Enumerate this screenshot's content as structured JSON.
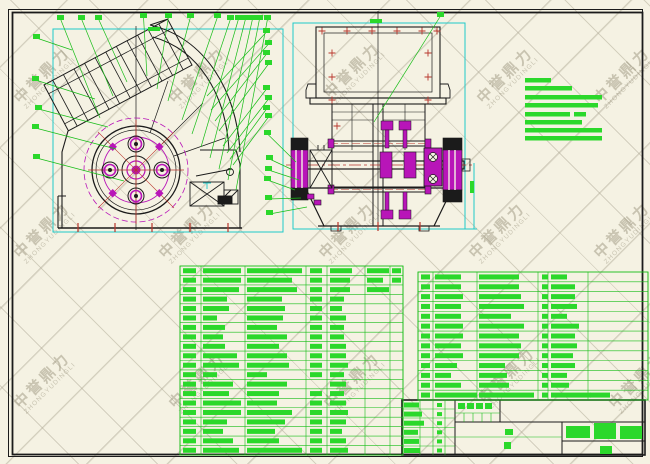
{
  "drawing_type": "cad-assembly-drawing",
  "watermark": {
    "text_cn": "中誉鼎力",
    "text_en": "ZHONGYUDINGLI",
    "positions": [
      [
        45,
        85
      ],
      [
        200,
        85
      ],
      [
        355,
        80
      ],
      [
        508,
        85
      ],
      [
        625,
        85
      ],
      [
        45,
        240
      ],
      [
        190,
        240
      ],
      [
        350,
        240
      ],
      [
        500,
        240
      ],
      [
        625,
        240
      ],
      [
        45,
        390
      ],
      [
        200,
        390
      ],
      [
        355,
        390
      ],
      [
        510,
        385
      ],
      [
        640,
        390
      ]
    ]
  },
  "colors": {
    "background": "#f5f2e3",
    "line": "#1b1b1b",
    "green_fill": "#2bd82b",
    "green_line": "#17bd17",
    "cyan": "#1fc9c9",
    "magenta": "#b815b8",
    "red": "#b8352b",
    "watermark": "#968e7a"
  },
  "callouts": [
    [
      57,
      15,
      100,
      118
    ],
    [
      78,
      15,
      113,
      96
    ],
    [
      95,
      15,
      127,
      82
    ],
    [
      140,
      13,
      147,
      76
    ],
    [
      165,
      13,
      157,
      89
    ],
    [
      187,
      13,
      168,
      101
    ],
    [
      214,
      13,
      182,
      120
    ],
    [
      227,
      15,
      192,
      134
    ],
    [
      235,
      15,
      201,
      147
    ],
    [
      242,
      15,
      210,
      158
    ],
    [
      249,
      15,
      219,
      169
    ],
    [
      256,
      15,
      228,
      180
    ],
    [
      264,
      15,
      236,
      190
    ],
    [
      33,
      34,
      72,
      50
    ],
    [
      32,
      76,
      95,
      99
    ],
    [
      35,
      105,
      108,
      127
    ],
    [
      32,
      124,
      116,
      149
    ],
    [
      33,
      154,
      124,
      181
    ],
    [
      263,
      28,
      207,
      96
    ],
    [
      265,
      40,
      211,
      110
    ],
    [
      263,
      50,
      215,
      121
    ],
    [
      265,
      60,
      219,
      131
    ],
    [
      263,
      85,
      223,
      146
    ],
    [
      265,
      95,
      227,
      153
    ],
    [
      263,
      105,
      230,
      159
    ],
    [
      265,
      113,
      233,
      165
    ],
    [
      264,
      130,
      296,
      162
    ],
    [
      266,
      155,
      293,
      170
    ],
    [
      265,
      166,
      299,
      180
    ],
    [
      264,
      176,
      295,
      190
    ],
    [
      265,
      195,
      301,
      198
    ],
    [
      266,
      210,
      307,
      207
    ],
    [
      437,
      12,
      374,
      122
    ]
  ],
  "dimension_marks": [
    [
      148,
      27,
      12,
      4
    ],
    [
      370,
      19,
      12,
      4
    ],
    [
      470,
      181,
      4,
      12
    ]
  ],
  "tech_notes": {
    "x": 525,
    "bar_h": 4.5,
    "bars": [
      [
        78,
        26,
        0
      ],
      [
        86,
        47,
        0
      ],
      [
        95,
        77,
        0
      ],
      [
        103,
        73,
        0
      ],
      [
        112,
        45,
        12
      ],
      [
        120,
        57,
        0
      ],
      [
        128,
        77,
        0
      ],
      [
        136,
        77,
        0
      ]
    ]
  },
  "red_marks": {
    "plus": [
      [
        322,
        31
      ],
      [
        347,
        31
      ],
      [
        372,
        31
      ],
      [
        397,
        31
      ],
      [
        422,
        31
      ],
      [
        437,
        31
      ],
      [
        332,
        53
      ],
      [
        332,
        77
      ],
      [
        332,
        100
      ],
      [
        428,
        53
      ],
      [
        428,
        77
      ],
      [
        428,
        100
      ],
      [
        337,
        126
      ]
    ],
    "ticks": [
      [
        78,
        228
      ],
      [
        115,
        228
      ],
      [
        152,
        228
      ],
      [
        190,
        228
      ],
      [
        228,
        228
      ],
      [
        338,
        227
      ],
      [
        378,
        227
      ],
      [
        420,
        227
      ]
    ]
  },
  "bom_left": {
    "x": 180,
    "y": 266,
    "h": 189,
    "rows": 20,
    "cols": [
      0,
      21,
      65,
      126,
      147,
      185,
      210,
      223
    ],
    "seq_w": 13,
    "qty_w": 12,
    "data": [
      [
        38,
        55,
        1,
        22,
        22,
        1
      ],
      [
        38,
        45,
        1,
        20,
        16,
        1
      ],
      [
        36,
        50,
        1,
        20,
        22,
        0
      ],
      [
        24,
        35,
        1,
        14,
        0,
        0
      ],
      [
        26,
        38,
        1,
        12,
        0,
        0
      ],
      [
        14,
        36,
        1,
        16,
        0,
        0
      ],
      [
        22,
        30,
        1,
        14,
        0,
        0
      ],
      [
        20,
        40,
        1,
        14,
        0,
        0
      ],
      [
        22,
        32,
        1,
        16,
        0,
        0
      ],
      [
        34,
        40,
        1,
        16,
        0,
        0
      ],
      [
        36,
        42,
        1,
        18,
        0,
        0
      ],
      [
        14,
        20,
        1,
        14,
        0,
        0
      ],
      [
        30,
        40,
        0,
        16,
        0,
        0
      ],
      [
        26,
        32,
        1,
        14,
        0,
        0
      ],
      [
        38,
        30,
        1,
        16,
        0,
        0
      ],
      [
        38,
        45,
        1,
        18,
        0,
        0
      ],
      [
        24,
        38,
        1,
        16,
        0,
        0
      ],
      [
        20,
        28,
        1,
        12,
        0,
        0
      ],
      [
        30,
        32,
        1,
        16,
        0,
        0
      ],
      [
        36,
        55,
        1,
        18,
        0,
        0
      ]
    ]
  },
  "bom_right": {
    "x": 418,
    "y": 272,
    "h": 128,
    "rows": 13,
    "cols": [
      0,
      15,
      59,
      120,
      130,
      170,
      230
    ],
    "seq_w": 9,
    "qty_w": 6,
    "data": [
      [
        26,
        40,
        1,
        16,
        0,
        0
      ],
      [
        26,
        40,
        1,
        24,
        0,
        0
      ],
      [
        28,
        42,
        1,
        24,
        0,
        0
      ],
      [
        26,
        45,
        1,
        26,
        0,
        0
      ],
      [
        26,
        32,
        1,
        16,
        0,
        0
      ],
      [
        28,
        45,
        1,
        28,
        0,
        0
      ],
      [
        28,
        40,
        1,
        24,
        0,
        0
      ],
      [
        26,
        42,
        1,
        26,
        0,
        0
      ],
      [
        28,
        40,
        1,
        22,
        0,
        0
      ],
      [
        22,
        26,
        1,
        24,
        0,
        0
      ],
      [
        16,
        28,
        1,
        16,
        0,
        0
      ],
      [
        26,
        30,
        1,
        18,
        0,
        0
      ],
      [
        42,
        55,
        1,
        40,
        20,
        0
      ]
    ]
  },
  "title_block": {
    "frame": [
      402,
      400,
      243,
      55
    ],
    "sig_rows": 6,
    "sig_widths": [
      15,
      18,
      20,
      14,
      15,
      16
    ],
    "sig_text_x": 404,
    "sig_tick_x": 437,
    "header_cells_x": [
      458,
      467,
      476,
      485
    ],
    "header_y": 403,
    "values": [
      [
        505,
        429,
        8,
        6
      ],
      [
        504,
        442,
        7,
        7
      ]
    ],
    "title_bars": [
      [
        566,
        426,
        24,
        12
      ],
      [
        594,
        423,
        22,
        16
      ],
      [
        620,
        426,
        22,
        13
      ],
      [
        600,
        446,
        12,
        8
      ]
    ]
  }
}
